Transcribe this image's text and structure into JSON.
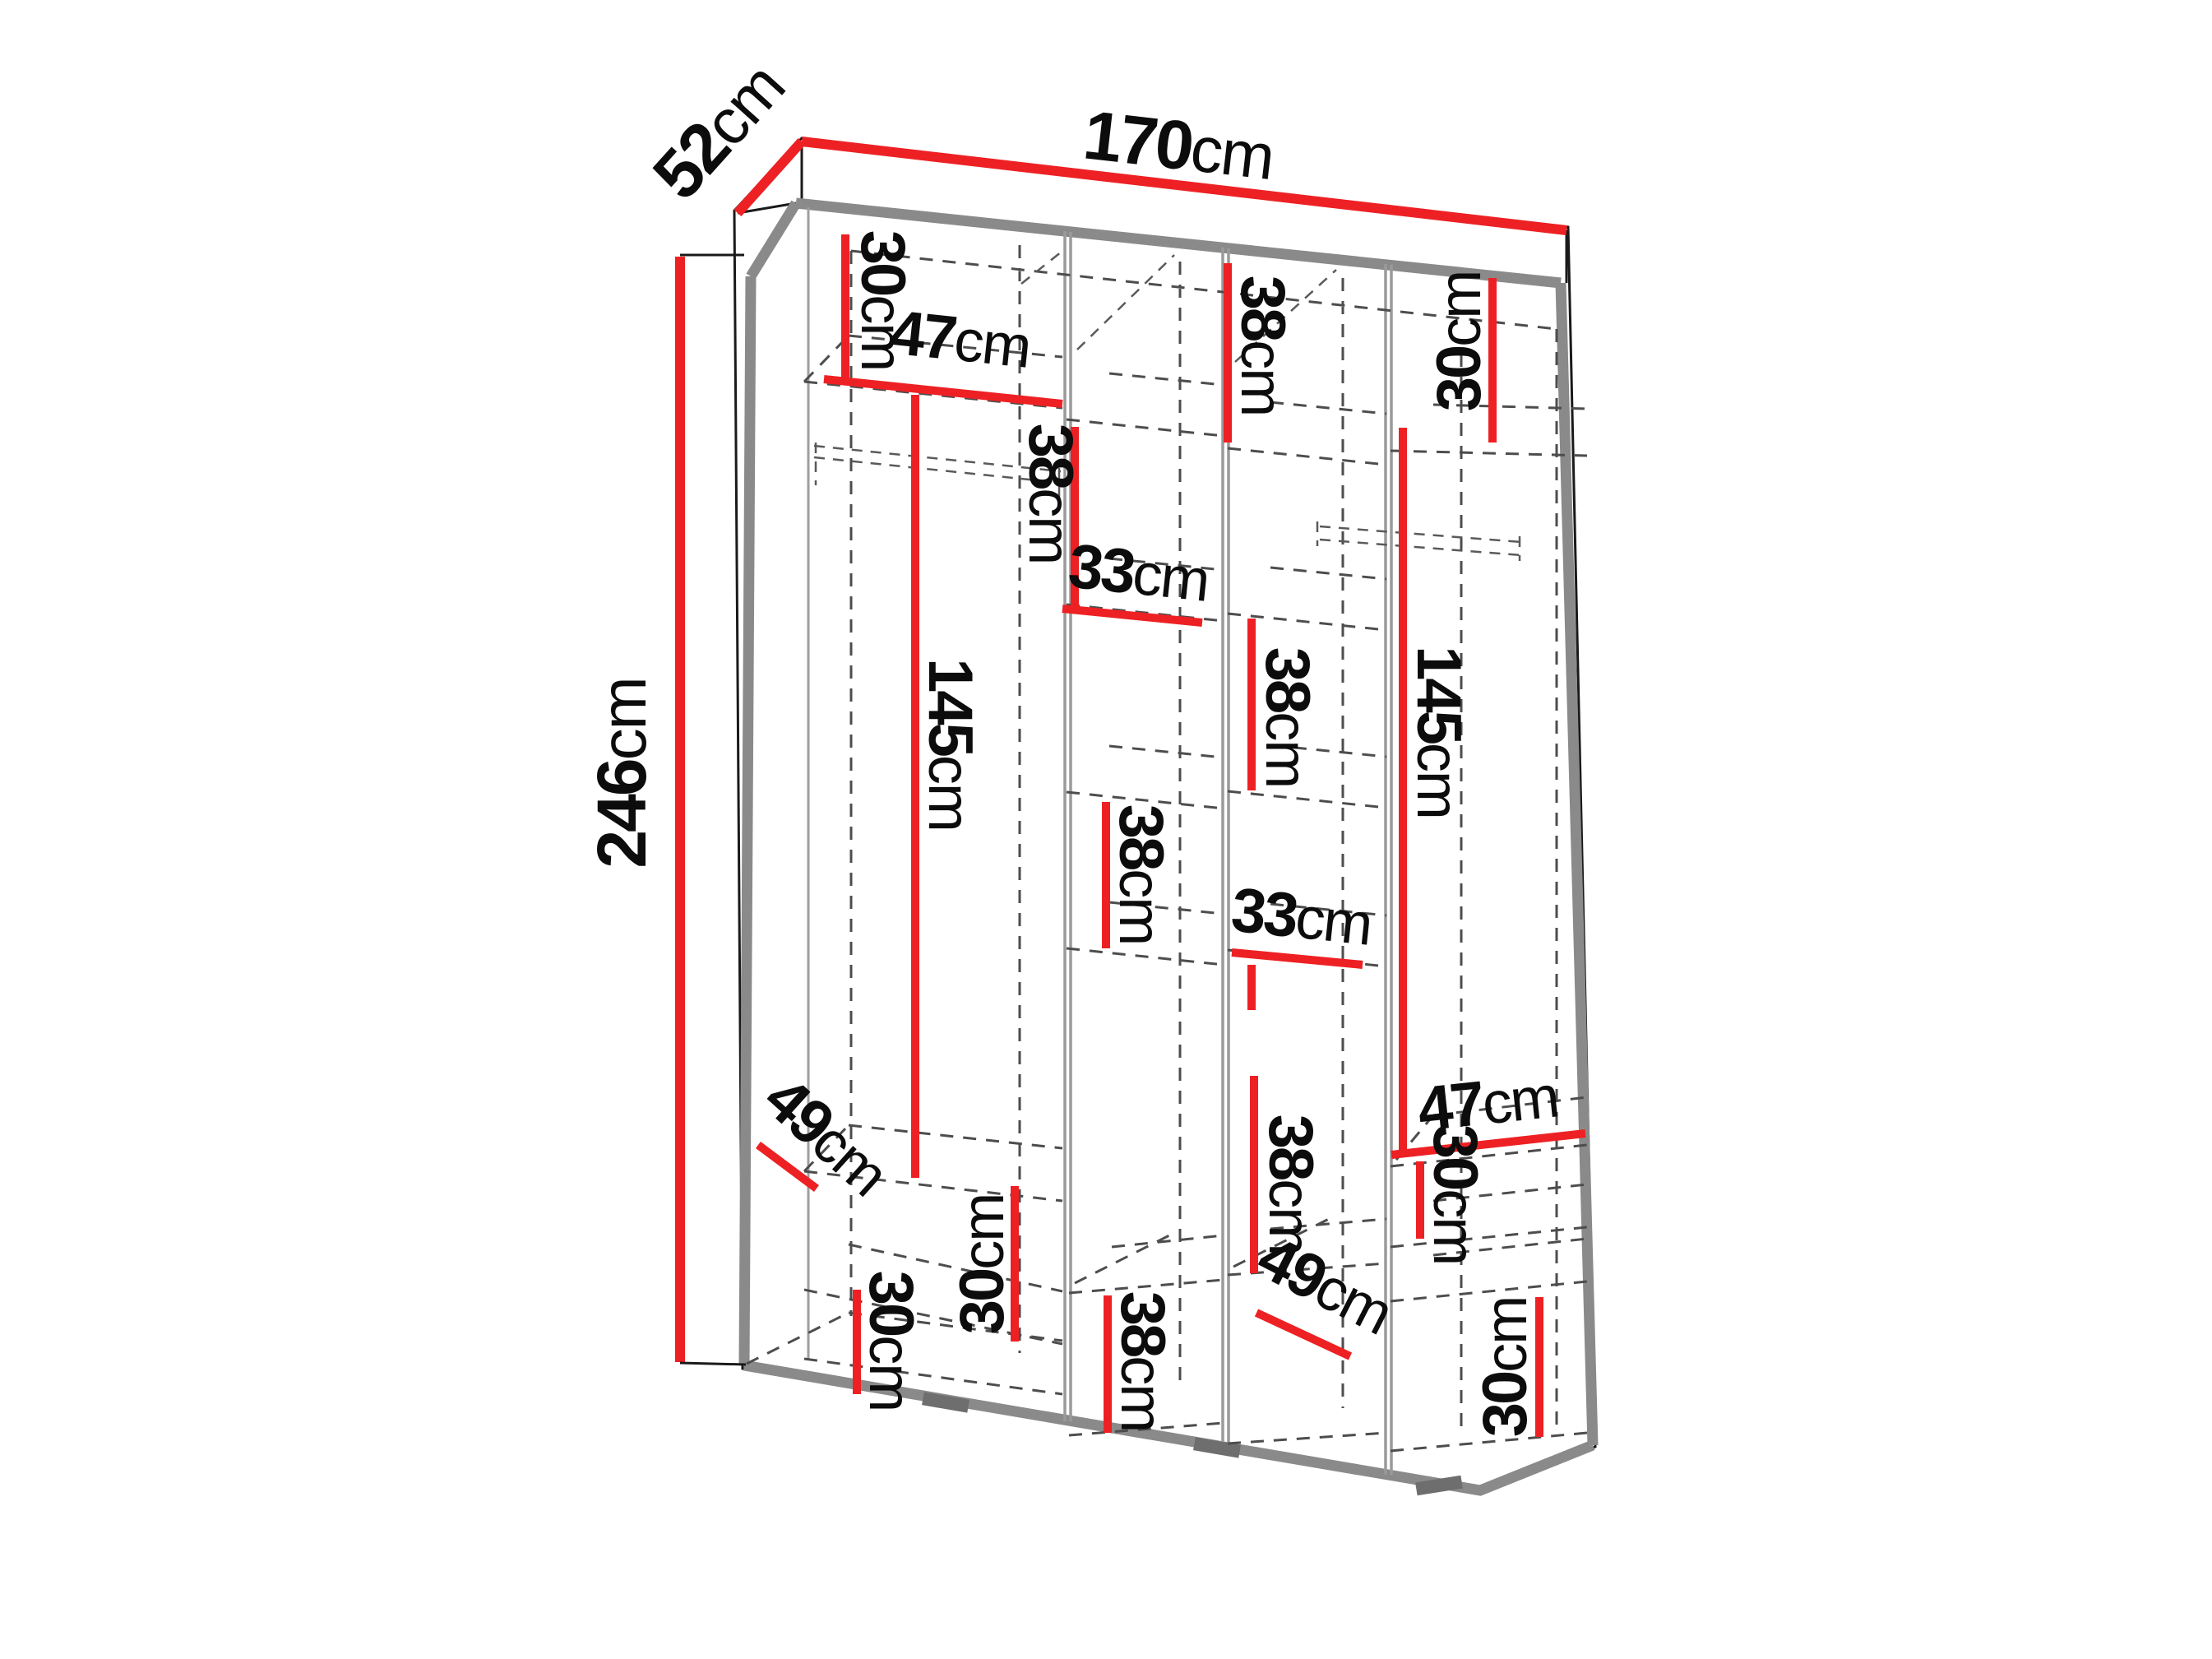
{
  "diagram": {
    "title": "wardrobe-dimension-diagram",
    "colors": {
      "dimension_red": "#ed2124",
      "frame_gray": "#8a8a8a",
      "dash_gray": "#4d4d4d",
      "text_black": "#0c0c0c",
      "background": "#ffffff"
    },
    "overall": {
      "width": {
        "value": "170",
        "unit": "cm"
      },
      "depth": {
        "value": "52",
        "unit": "cm"
      },
      "height": {
        "value": "246",
        "unit": "cm"
      }
    },
    "interior": {
      "c1_top": {
        "value": "30",
        "unit": "cm"
      },
      "c1_width": {
        "value": "47",
        "unit": "cm"
      },
      "c1_hanging": {
        "value": "145",
        "unit": "cm"
      },
      "c1_depth": {
        "value": "49",
        "unit": "cm"
      },
      "c1_lower": {
        "value": "30",
        "unit": "cm"
      },
      "c1_bottom": {
        "value": "30",
        "unit": "cm"
      },
      "c2_top": {
        "value": "38",
        "unit": "cm"
      },
      "c2_width": {
        "value": "33",
        "unit": "cm"
      },
      "c2_middle": {
        "value": "38",
        "unit": "cm"
      },
      "c2_bottom": {
        "value": "38",
        "unit": "cm"
      },
      "c3_top": {
        "value": "38",
        "unit": "cm"
      },
      "c3_upper": {
        "value": "38",
        "unit": "cm"
      },
      "c3_width": {
        "value": "33",
        "unit": "cm"
      },
      "c3_lower": {
        "value": "38",
        "unit": "cm"
      },
      "c3_depth": {
        "value": "49",
        "unit": "cm"
      },
      "c4_top": {
        "value": "30",
        "unit": "cm"
      },
      "c4_hanging": {
        "value": "145",
        "unit": "cm"
      },
      "c4_width": {
        "value": "47",
        "unit": "cm"
      },
      "c4_middle": {
        "value": "30",
        "unit": "cm"
      },
      "c4_bottom": {
        "value": "30",
        "unit": "cm"
      }
    }
  }
}
